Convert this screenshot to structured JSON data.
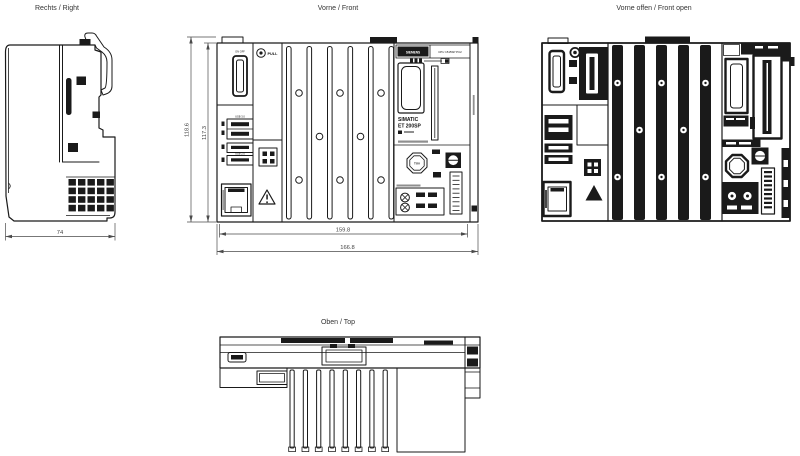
{
  "style": {
    "background": "#ffffff",
    "line_color": "#1a1a1a",
    "dim_color": "#4a4a4a"
  },
  "views": {
    "right": {
      "title": "Rechts / Right",
      "dims": {
        "depth_mm": "74"
      }
    },
    "front": {
      "title": "Vorne / Front",
      "dims": {
        "overall_height_mm": "118.6",
        "body_height_mm": "117.3",
        "body_width_mm": "159.8",
        "overall_width_mm": "166.8"
      },
      "labels": {
        "power": "ON OFF",
        "pull": "PULL",
        "usb3": "USB 3.0",
        "usb2": "USB 2.0",
        "brand": "SIEMENS",
        "model": "CPU 1515SP PC2",
        "series": "SIMATIC",
        "family": "ET 200SP",
        "badge": "TÜV"
      }
    },
    "front_open": {
      "title": "Vorne offen / Front open"
    },
    "top": {
      "title": "Oben / Top"
    }
  }
}
